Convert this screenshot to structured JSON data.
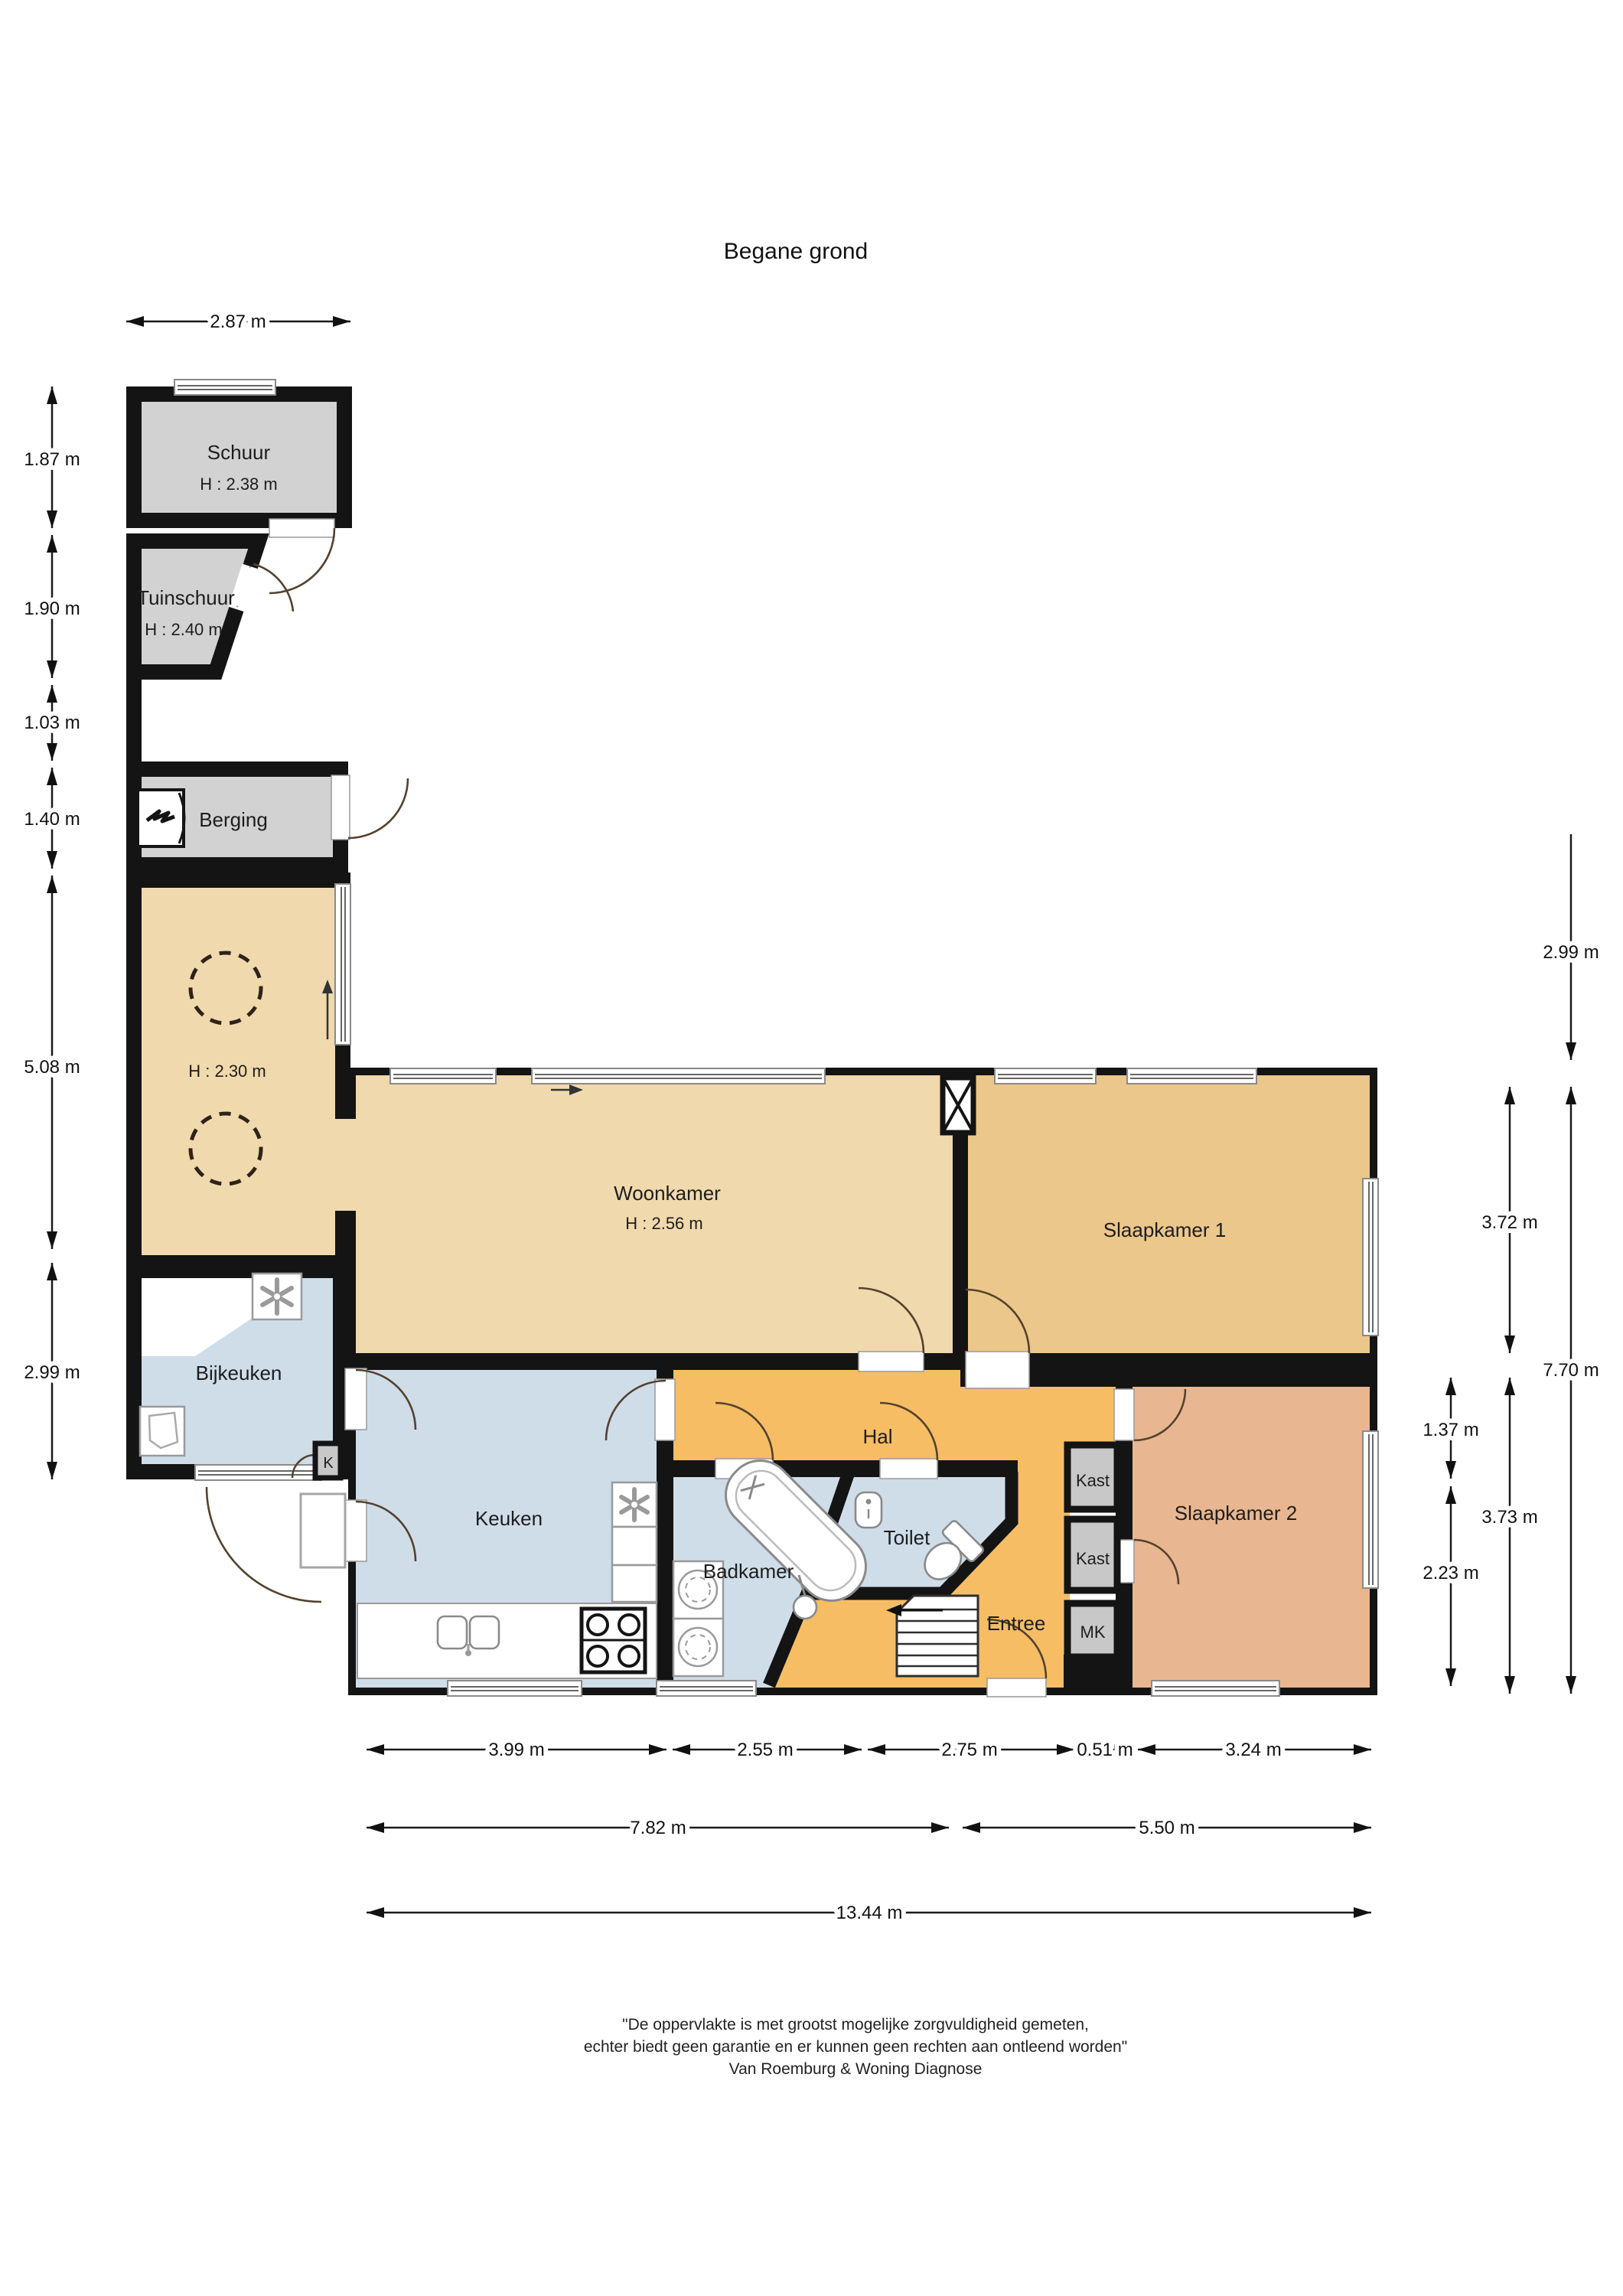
{
  "title": "Begane grond",
  "rooms": {
    "schuur": {
      "name": "Schuur",
      "height": "H : 2.38 m"
    },
    "tuinschuur": {
      "name": "Tuinschuur",
      "height": "H : 2.40 m"
    },
    "berging": {
      "name": "Berging"
    },
    "garage": {
      "height": "H : 2.30 m"
    },
    "woonkamer": {
      "name": "Woonkamer",
      "height": "H : 2.56 m"
    },
    "slaapkamer1": {
      "name": "Slaapkamer 1"
    },
    "slaapkamer2": {
      "name": "Slaapkamer 2"
    },
    "bijkeuken": {
      "name": "Bijkeuken"
    },
    "keuken": {
      "name": "Keuken"
    },
    "badkamer": {
      "name": "Badkamer"
    },
    "toilet": {
      "name": "Toilet"
    },
    "hal": {
      "name": "Hal"
    },
    "entree": {
      "name": "Entree"
    },
    "kast1": {
      "name": "Kast"
    },
    "kast2": {
      "name": "Kast"
    },
    "mk": {
      "name": "MK"
    },
    "k": {
      "name": "K"
    }
  },
  "dimensions": {
    "top": [
      "2.87 m"
    ],
    "left": [
      "1.87 m",
      "1.90 m",
      "1.03 m",
      "1.40 m",
      "5.08 m",
      "2.99 m"
    ],
    "right": [
      "2.99 m",
      "7.70 m",
      "3.72 m",
      "3.73 m",
      "1.37 m",
      "2.23 m"
    ],
    "bottom_row1": [
      "3.99 m",
      "2.55 m",
      "2.75 m",
      "0.51 m",
      "3.24 m"
    ],
    "bottom_row2": [
      "7.82 m",
      "5.50 m"
    ],
    "bottom_row3": [
      "13.44 m"
    ]
  },
  "footer": {
    "line1": "\"De oppervlakte is met grootst mogelijke zorgvuldigheid gemeten,",
    "line2": "echter biedt geen garantie en er kunnen geen rechten aan ontleend worden\"",
    "line3": "Van Roemburg & Woning Diagnose"
  },
  "colors": {
    "wall": "#141414",
    "outbuilding": "#d2d2d2",
    "living_tan": "#f0d9ad",
    "bedroom1_tan": "#ecc78b",
    "bedroom2_salmon": "#e8b791",
    "hall_orange": "#f6bd65",
    "wet_blue": "#cfdde9",
    "closet_gray": "#c8c8c8"
  }
}
